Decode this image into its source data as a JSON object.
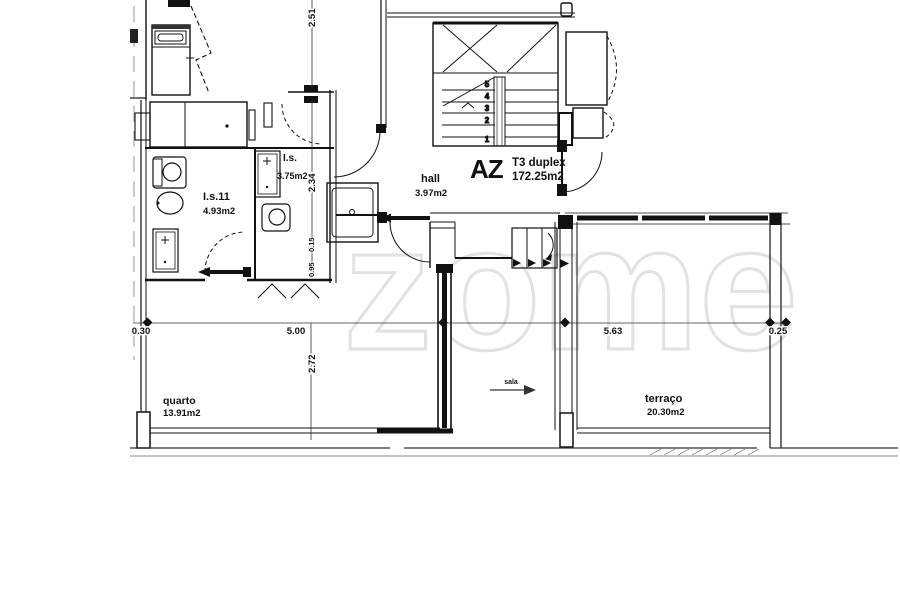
{
  "watermark": {
    "text": "zome",
    "color": "#e2e2e2"
  },
  "unit": {
    "code": "AZ",
    "type": "T3 duplex",
    "area": "172.25m2"
  },
  "rooms": {
    "hall": {
      "name": "hall",
      "area": "3.97m2"
    },
    "bathroom_main": {
      "name": "I.s.11",
      "area": "4.93m2"
    },
    "bathroom_small": {
      "name": "I.s.",
      "area": "3.75m2"
    },
    "bedroom": {
      "name": "quarto",
      "area": "13.91m2"
    },
    "terrace": {
      "name": "terraço",
      "area": "20.30m2"
    },
    "living_pointer": {
      "name": "sala"
    }
  },
  "dimensions": {
    "v_top": "2.51",
    "v_mid": "2.34",
    "v_small_top": "0.15",
    "v_small_bottom": "0.95",
    "h_left": "0.30",
    "h_bedroom": "5.00",
    "v_bedroom": "2.72",
    "h_terrace": "5.63",
    "h_right": "0.25"
  },
  "stairs": {
    "steps": [
      "5",
      "4",
      "3",
      "2",
      "1"
    ]
  },
  "colors": {
    "line": "#111111",
    "dim": "#333333",
    "background": "#ffffff"
  }
}
